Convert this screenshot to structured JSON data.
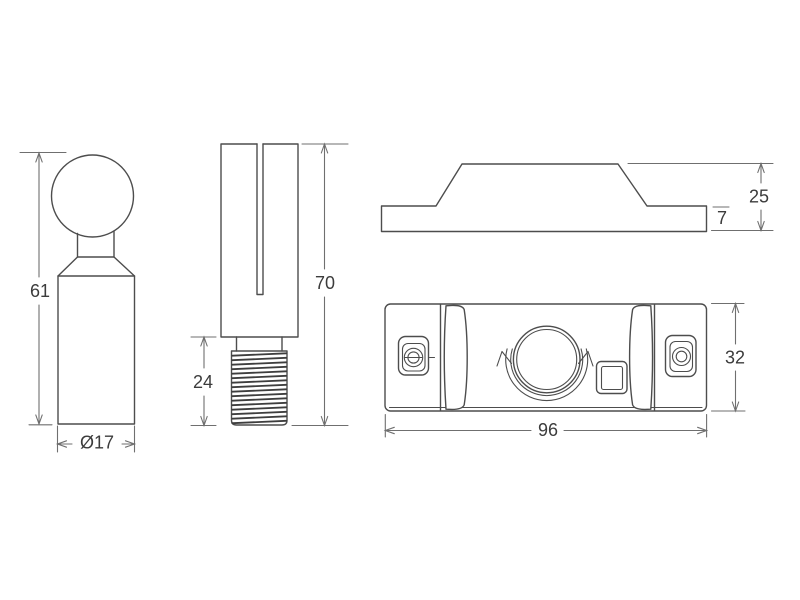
{
  "colors": {
    "background": "#ffffff",
    "outline": "#4d4d4d",
    "dimension": "#6f6f6f",
    "label": "#3c3c3c"
  },
  "dimensions": {
    "knob": {
      "height": "61",
      "diameter": "Ø17"
    },
    "pin": {
      "length": "70",
      "thread_length": "24"
    },
    "profile": {
      "height": "25",
      "base_thickness": "7"
    },
    "housing": {
      "width": "96",
      "height": "32"
    }
  }
}
